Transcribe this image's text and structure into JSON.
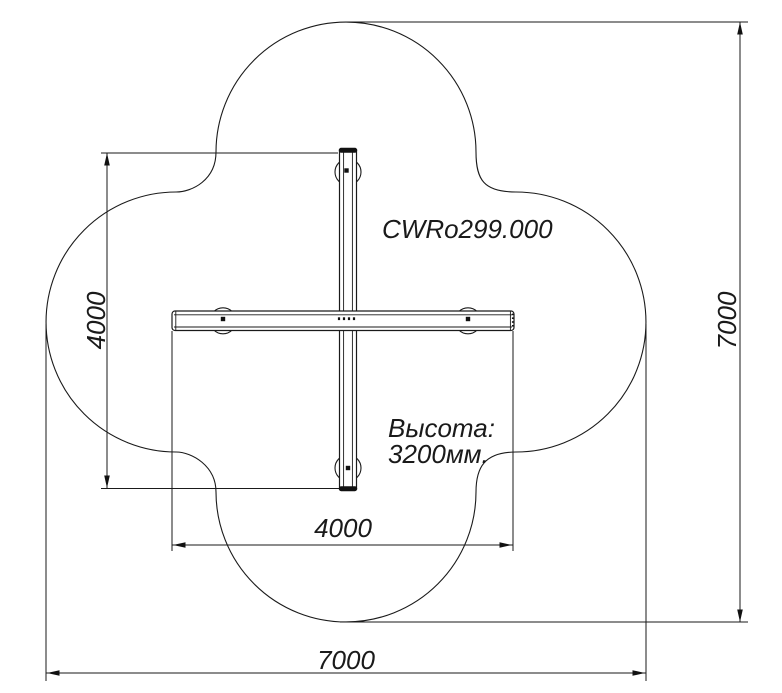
{
  "drawing": {
    "title": "CWRo299.000",
    "height_note": {
      "line1": "Высота:",
      "line2": "3200мм."
    },
    "dims": {
      "beam_vertical_length": "4000",
      "beam_horizontal_length": "4000",
      "zone_height": "7000",
      "zone_width": "7000"
    },
    "colors": {
      "line": "#1a1a1a",
      "background": "#ffffff"
    }
  }
}
